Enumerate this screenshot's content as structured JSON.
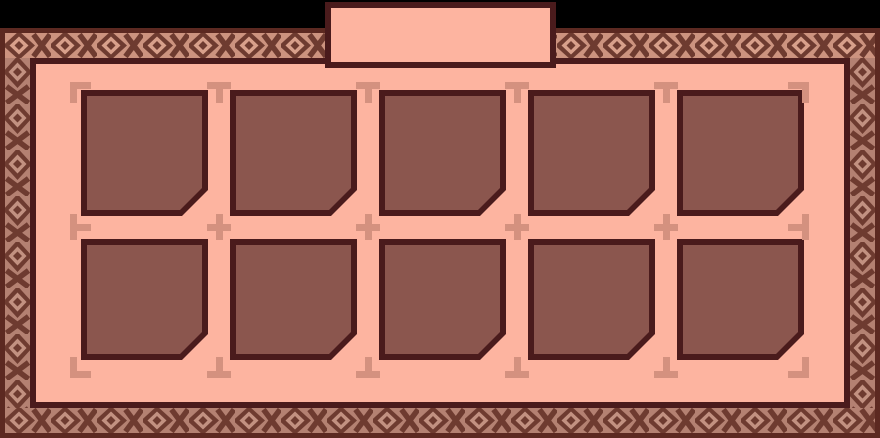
{
  "app": {
    "name": "inventory-panel",
    "kind": "game-storage-grid"
  },
  "tab": {
    "label": ""
  },
  "grid": {
    "rows": 2,
    "columns": 5,
    "slot_count": 10,
    "slots": [
      {
        "id": 1,
        "state": "empty"
      },
      {
        "id": 2,
        "state": "empty"
      },
      {
        "id": 3,
        "state": "empty"
      },
      {
        "id": 4,
        "state": "empty"
      },
      {
        "id": 5,
        "state": "empty"
      },
      {
        "id": 6,
        "state": "empty"
      },
      {
        "id": 7,
        "state": "empty"
      },
      {
        "id": 8,
        "state": "empty"
      },
      {
        "id": 9,
        "state": "empty"
      },
      {
        "id": 10,
        "state": "empty"
      }
    ]
  },
  "markers": [
    {
      "type": "corner-tl",
      "x": 70,
      "y": 82
    },
    {
      "type": "t-down",
      "x": 207,
      "y": 82
    },
    {
      "type": "t-down",
      "x": 356,
      "y": 82
    },
    {
      "type": "t-down",
      "x": 505,
      "y": 82
    },
    {
      "type": "t-down",
      "x": 654,
      "y": 82
    },
    {
      "type": "corner-tr",
      "x": 785,
      "y": 82
    },
    {
      "type": "t-right",
      "x": 70,
      "y": 214
    },
    {
      "type": "plus",
      "x": 207,
      "y": 214
    },
    {
      "type": "plus",
      "x": 356,
      "y": 214
    },
    {
      "type": "plus",
      "x": 505,
      "y": 214
    },
    {
      "type": "plus",
      "x": 654,
      "y": 214
    },
    {
      "type": "t-left",
      "x": 785,
      "y": 214
    },
    {
      "type": "corner-bl",
      "x": 70,
      "y": 352
    },
    {
      "type": "t-up",
      "x": 207,
      "y": 352
    },
    {
      "type": "t-up",
      "x": 356,
      "y": 352
    },
    {
      "type": "t-up",
      "x": 505,
      "y": 352
    },
    {
      "type": "t-up",
      "x": 654,
      "y": 352
    },
    {
      "type": "corner-br",
      "x": 785,
      "y": 352
    }
  ],
  "colors": {
    "page_bg": "#000000",
    "outer_border": "#5c2921",
    "line": "#4a1b1c",
    "panel_bg": "#fdb4a0",
    "slot_bg": "#8b564e",
    "marker": "#d4917f",
    "band_dark": "#6e3b30",
    "band_bg_light": "#cc937f",
    "band_in_light": "#d8a08b",
    "band_bg_dark": "#b48172",
    "band_in_dark": "#c29181"
  }
}
